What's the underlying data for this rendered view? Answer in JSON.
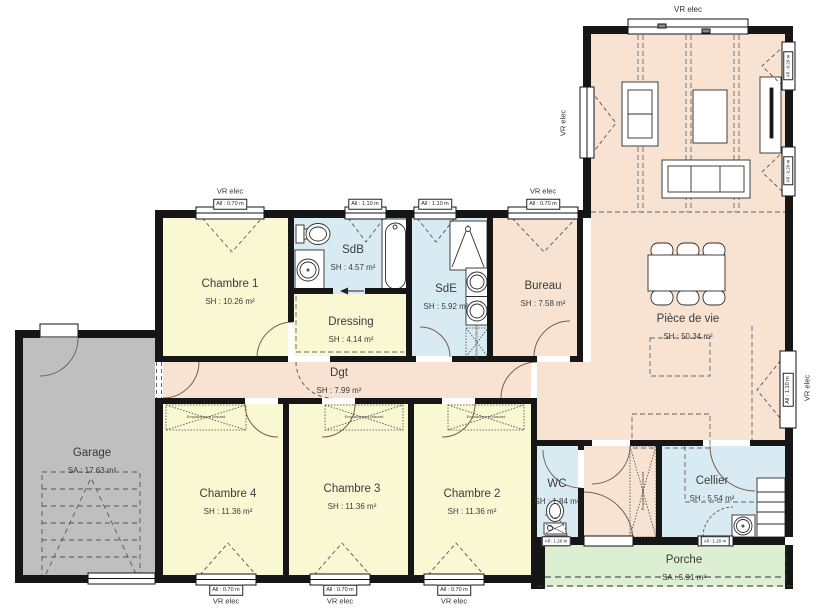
{
  "rooms": [
    {
      "id": "chambre1",
      "name": "Chambre 1",
      "area": "SH : 10.26 m²"
    },
    {
      "id": "sdb",
      "name": "SdB",
      "area": "SH : 4.57 m²"
    },
    {
      "id": "dressing",
      "name": "Dressing",
      "area": "SH : 4.14 m²"
    },
    {
      "id": "sde",
      "name": "SdE",
      "area": "SH : 5.92 m²"
    },
    {
      "id": "bureau",
      "name": "Bureau",
      "area": "SH : 7.58 m²"
    },
    {
      "id": "piece_de_vie",
      "name": "Pièce de vie",
      "area": "SH : 50.34 m²"
    },
    {
      "id": "dgt",
      "name": "Dgt",
      "area": "SH : 7.99 m²"
    },
    {
      "id": "chambre4",
      "name": "Chambre 4",
      "area": "SH : 11.36 m²"
    },
    {
      "id": "chambre3",
      "name": "Chambre 3",
      "area": "SH : 11.36 m²"
    },
    {
      "id": "chambre2",
      "name": "Chambre 2",
      "area": "SH : 11.36 m²"
    },
    {
      "id": "wc",
      "name": "WC",
      "area": "SH : 1.84 m²"
    },
    {
      "id": "cellier",
      "name": "Cellier",
      "area": "SH : 5.54 m²"
    },
    {
      "id": "garage",
      "name": "Garage",
      "area": "SA : 17.63 m²"
    },
    {
      "id": "porche",
      "name": "Porche",
      "area": "SA : 5.91 m²"
    }
  ],
  "window_labels": {
    "top_ch1": {
      "vr": "VR elec",
      "all": "All : 0.70 m"
    },
    "top_sdb": {
      "all": "All : 1.10 m"
    },
    "top_sde": {
      "all": "All : 1.10 m"
    },
    "top_bureau": {
      "vr": "VR elec",
      "all": "All : 0.70 m"
    },
    "bay": {
      "vr": "VR elec"
    },
    "left_living": {
      "vr": "VR elec"
    },
    "right_small_1": {
      "all": "All : 0.20 m"
    },
    "right_small_2": {
      "all": "All : 0.20 m"
    },
    "right_main": {
      "vr": "VR elec",
      "all": "All : 1.10 m"
    },
    "bottom_ch4": {
      "vr": "VR elec",
      "all": "All : 0.70 m"
    },
    "bottom_ch3": {
      "vr": "VR elec",
      "all": "All : 0.70 m"
    },
    "bottom_ch2": {
      "vr": "VR elec",
      "all": "All : 0.70 m"
    },
    "bottom_wc": {
      "all": "All : 1.20 m"
    },
    "bottom_cellier": {
      "all": "All : 1.20 m"
    }
  },
  "annotations": {
    "closet": "Emplacement placard"
  },
  "colors": {
    "wall": "#161616",
    "bedroom_yellow": "#FAF8D2",
    "bath_blue": "#D9EBF2",
    "living_peach": "#F8E3D2",
    "garage_gray": "#BFBFBF",
    "porch_green": "#DCEFD3",
    "door_arc": "#7a5c49",
    "text": "#3b3b3b"
  }
}
